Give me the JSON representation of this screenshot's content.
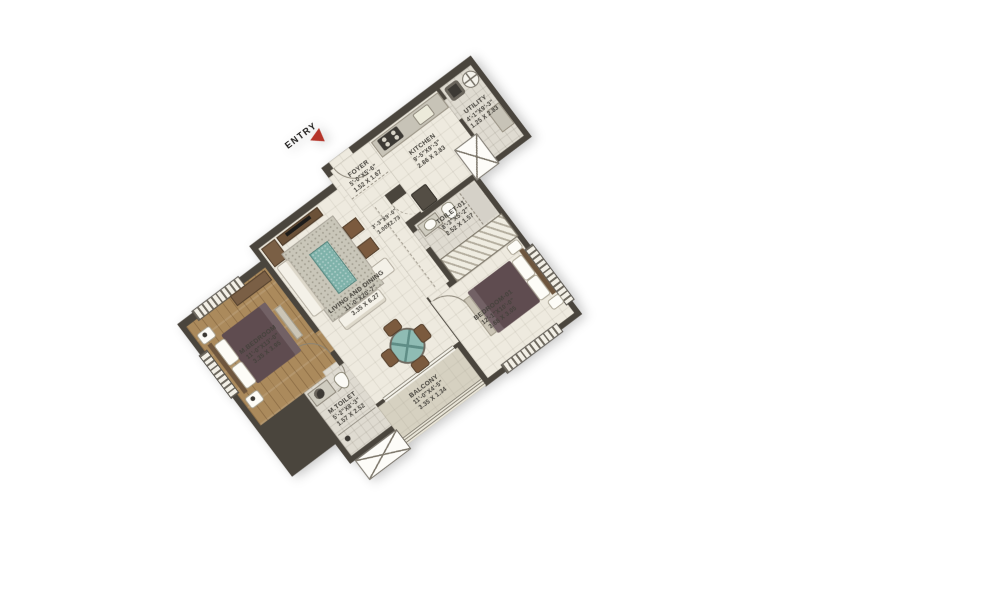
{
  "entry": {
    "label": "ENTRY"
  },
  "rooms": {
    "m_bedroom": {
      "name": "M.BEDROOM",
      "imperial": "11'-0\"X13'-0\"",
      "metric": "3.35 X 3.95"
    },
    "m_toilet": {
      "name": "M.TOILET",
      "imperial": "5'-2\"X8'-3\"",
      "metric": "1.57 X 2.52"
    },
    "living_dining": {
      "name": "LIVING AND DINING",
      "imperial": "11'-0\"X20'-7\"",
      "metric": "3.35 X 6.27"
    },
    "balcony": {
      "name": "BALCONY",
      "imperial": "11'-0\"X4'-5\"",
      "metric": "3.35 X 1.34"
    },
    "foyer": {
      "name": "FOYER",
      "imperial": "5'-0\"X5'-6\"",
      "metric": "1.52 X 1.67"
    },
    "passage": {
      "imperial": "3'-3\"X9'-0\"",
      "metric": "1.00X2.73"
    },
    "kitchen": {
      "name": "KITCHEN",
      "imperial": "9'-5\"X9'-3\"",
      "metric": "2.86 X 2.83"
    },
    "utility": {
      "name": "UTILITY",
      "imperial": "4'-1\"X9'-3\"",
      "metric": "1.25 X 2.83"
    },
    "toilet_01": {
      "name": "TOILET-01",
      "imperial": "8'-3\"X5'-2\"",
      "metric": "2.52 X 1.57"
    },
    "bedroom_01": {
      "name": "BEDROOM-01",
      "imperial": "12'-1\"X10'-0\"",
      "metric": "3.68 X 3.05"
    }
  },
  "colors": {
    "wall": "#4a453d",
    "wood_floor": "#ab8a5c",
    "tile_floor": "#eeeadf",
    "wet_floor": "#dfdbd1",
    "balcony_floor": "#d6d1c1",
    "entry_arrow": "#b5342a",
    "rug_teal": "#7fb2aa",
    "bed_fabric": "#5f4c50",
    "furniture_wood": "#7a5f45"
  }
}
